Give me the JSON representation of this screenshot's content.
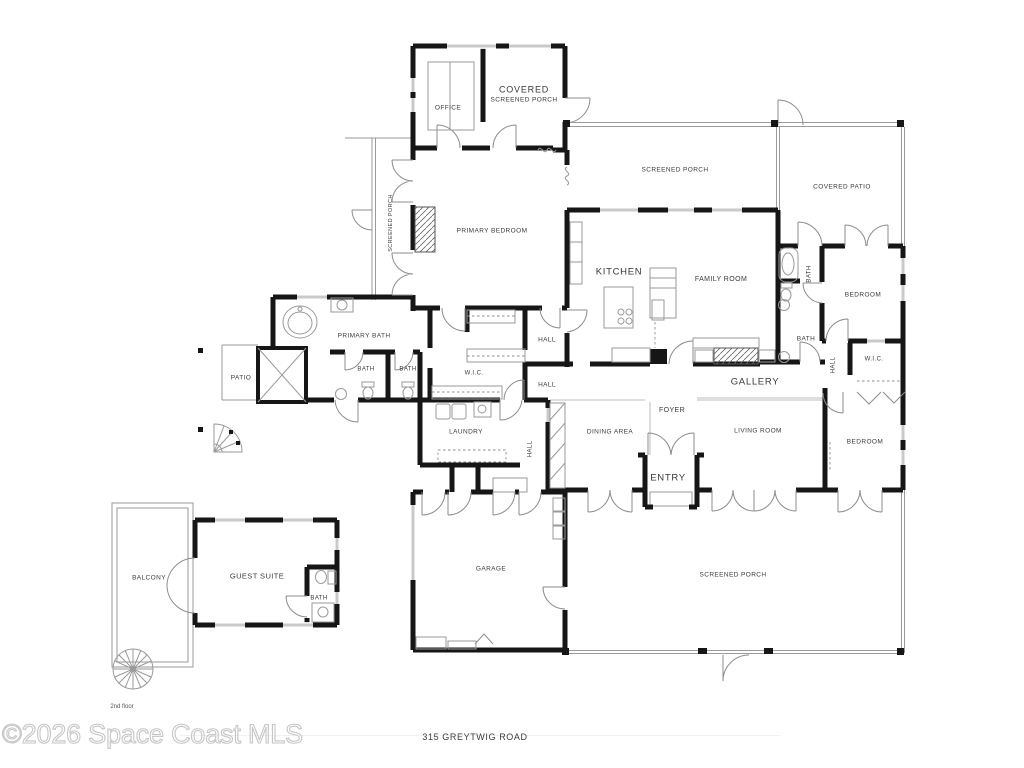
{
  "title_block": {
    "address": "315 GREYTWIG ROAD",
    "floor_note": "2nd floor",
    "watermark": "©2026 Space Coast MLS"
  },
  "rooms": {
    "office": "OFFICE",
    "covered_porch_line1": "COVERED",
    "covered_porch_line2": "SCREENED PORCH",
    "screened_porch_top": "SCREENED PORCH",
    "covered_patio": "COVERED PATIO",
    "screened_porch_left": "SCREENED PORCH",
    "primary_bedroom": "PRIMARY BEDROOM",
    "kitchen": "KITCHEN",
    "family_room": "FAMILY ROOM",
    "bath_upper_right": "BATH",
    "bedroom_upper_right": "BEDROOM",
    "primary_bath": "PRIMARY BATH",
    "hall_center_upper": "HALL",
    "bath_right_wing": "BATH",
    "patio": "PATIO",
    "bath_a": "BATH",
    "bath_b": "BATH",
    "wic_center": "W.I.C.",
    "hall_center_lower": "HALL",
    "gallery": "GALLERY",
    "hall_right": "HALL",
    "wic_right": "W.I.C.",
    "laundry": "LAUNDRY",
    "foyer": "FOYER",
    "dining_area": "DINING AREA",
    "living_room": "LIVING ROOM",
    "bedroom_lower_right": "BEDROOM",
    "hall_south": "HALL",
    "entry": "ENTRY",
    "garage": "GARAGE",
    "screened_porch_bottom": "SCREENED PORCH",
    "balcony": "BALCONY",
    "guest_suite": "GUEST SUITE",
    "guest_bath": "BATH"
  },
  "colors": {
    "wall": "#161616",
    "thin": "#9a9a9a",
    "window": "#c9c9c9",
    "label": "#3a3a3a",
    "watermark": "#c6c6c6"
  }
}
